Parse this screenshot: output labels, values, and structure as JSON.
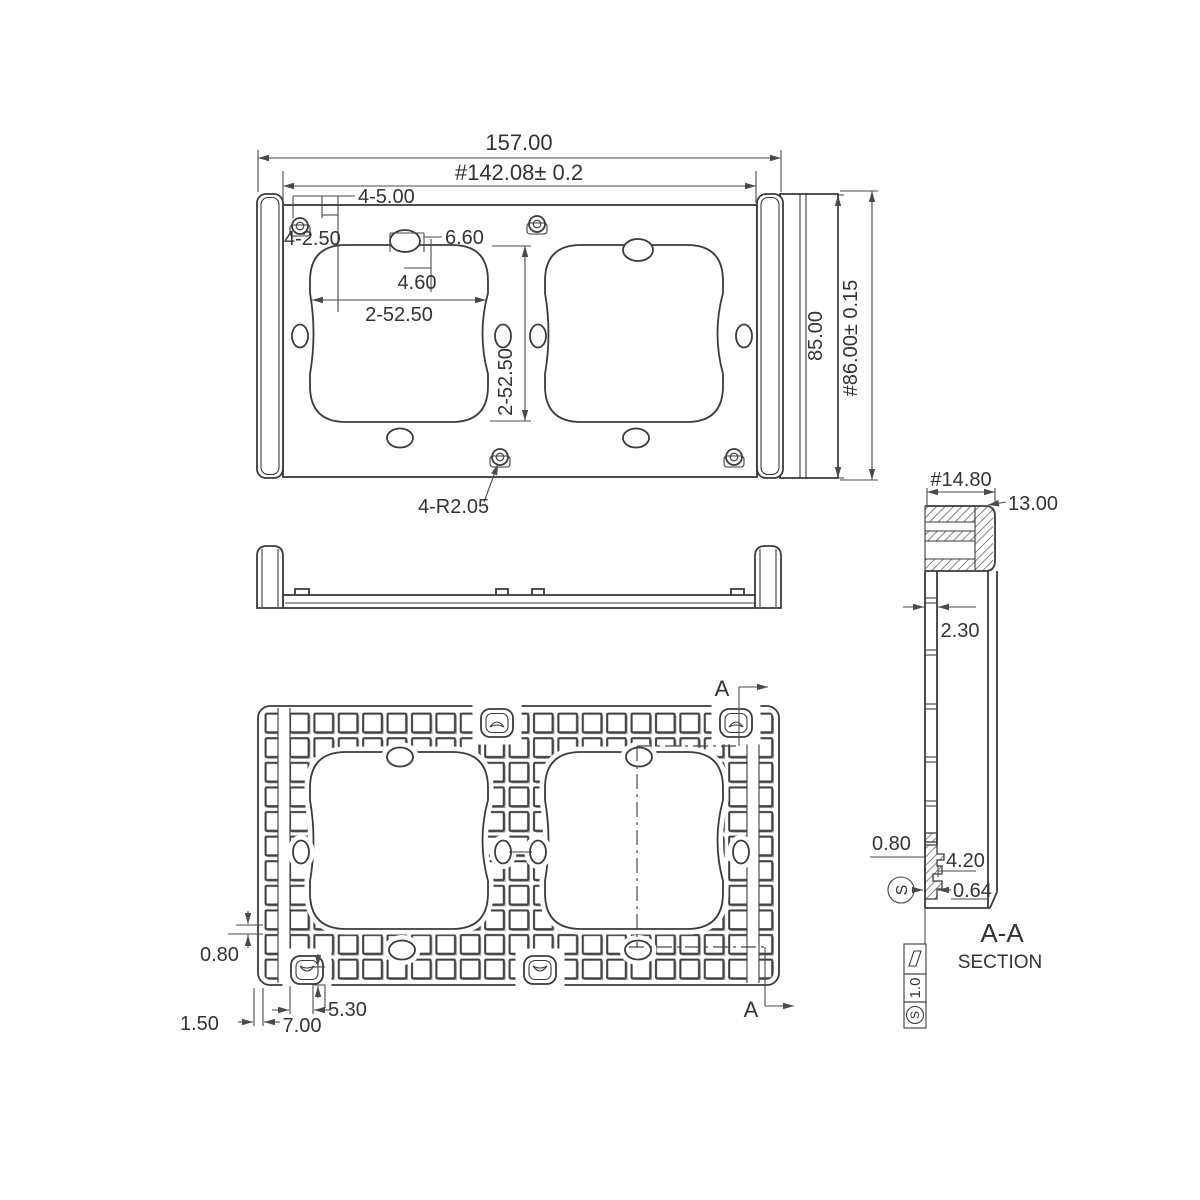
{
  "front_view": {
    "overall_width": "157.00",
    "mount_width": "#142.08± 0.2",
    "screw_holes": "4-5.00",
    "screw_offset": "4-2.50",
    "slot_width": "6.60",
    "slot_offset": "4.60",
    "cutout_width": "2-52.50",
    "cutout_height": "2-52.50",
    "overall_height": "85.00",
    "mount_height": "#86.00± 0.15",
    "corner_radius": "4-R2.05"
  },
  "back_view": {
    "rib_thickness": "0.80",
    "edge_offset": "1.50",
    "clip_slot_width": "7.00",
    "clip_slot_height": "5.30",
    "section_marker_top": "A",
    "section_marker_bottom": "A"
  },
  "section_view": {
    "name": "A-A",
    "label": "SECTION",
    "cap_width": "#14.80",
    "cap_height": "13.00",
    "wall_thickness": "2.30",
    "lip_thickness": "0.80",
    "clip_length": "4.20",
    "clip_gap": "0.64",
    "datum_letter": "S",
    "finish_value": "1.0",
    "finish_letter": "S"
  }
}
